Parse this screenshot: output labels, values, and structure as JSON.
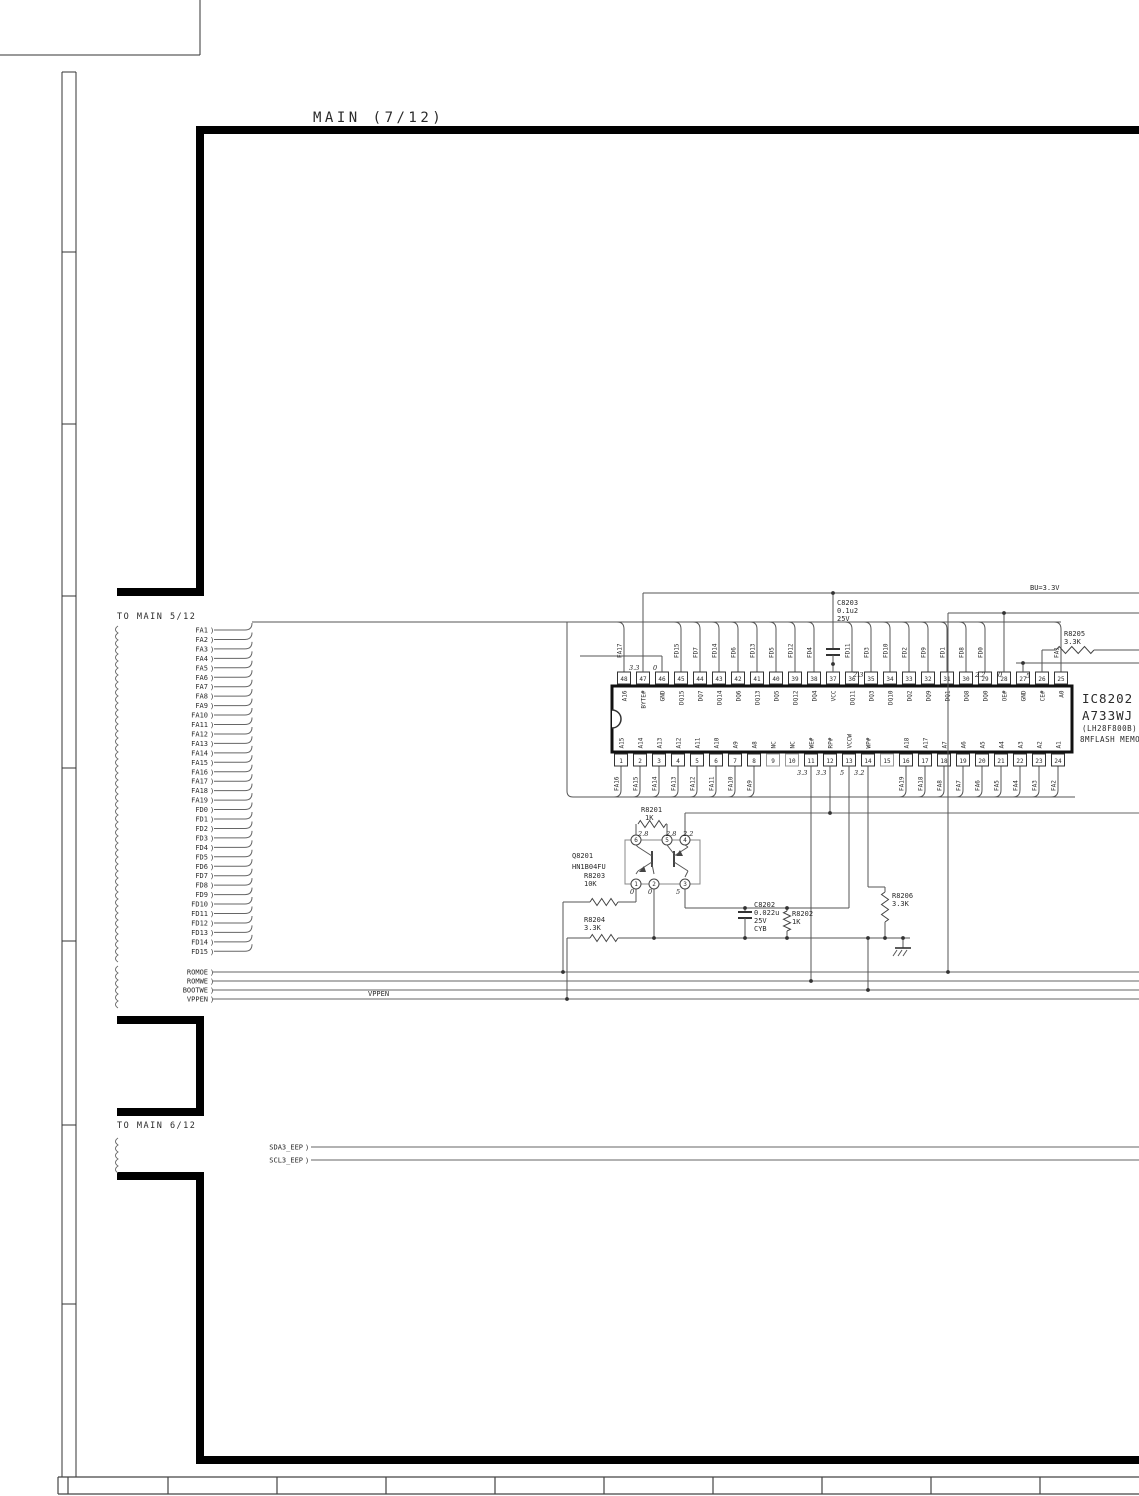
{
  "title": "MAIN (7/12)",
  "section_labels": {
    "to_main_5": "TO MAIN 5/12",
    "to_main_6": "TO MAIN 6/12"
  },
  "power_rail": "BU=3.3V",
  "bus_signals": [
    "FA1",
    "FA2",
    "FA3",
    "FA4",
    "FA5",
    "FA6",
    "FA7",
    "FA8",
    "FA9",
    "FA10",
    "FA11",
    "FA12",
    "FA13",
    "FA14",
    "FA15",
    "FA16",
    "FA17",
    "FA18",
    "FA19",
    "FD0",
    "FD1",
    "FD2",
    "FD3",
    "FD4",
    "FD5",
    "FD6",
    "FD7",
    "FD8",
    "FD9",
    "FD10",
    "FD11",
    "FD12",
    "FD13",
    "FD14",
    "FD15"
  ],
  "control_signals": [
    "ROMOE",
    "ROMWE",
    "BOOTWE",
    "VPPEN"
  ],
  "vppen_inline_label": "VPPEN",
  "eeprom_signals": [
    "SDA3_EEP",
    "SCL3_EEP"
  ],
  "ic": {
    "ref": "IC8202",
    "part": "A733WJ",
    "package": "(LH28F800B)",
    "description": "8MFLASH MEMORY",
    "top_pins": [
      {
        "pin": 48,
        "name": "A16",
        "net": "FA17"
      },
      {
        "pin": 47,
        "name": "BYTE#",
        "net": ""
      },
      {
        "pin": 46,
        "name": "GND",
        "net": ""
      },
      {
        "pin": 45,
        "name": "DQ15",
        "net": "FD15"
      },
      {
        "pin": 44,
        "name": "DQ7",
        "net": "FD7"
      },
      {
        "pin": 43,
        "name": "DQ14",
        "net": "FD14"
      },
      {
        "pin": 42,
        "name": "DQ6",
        "net": "FD6"
      },
      {
        "pin": 41,
        "name": "DQ13",
        "net": "FD13"
      },
      {
        "pin": 40,
        "name": "DQ5",
        "net": "FD5"
      },
      {
        "pin": 39,
        "name": "DQ12",
        "net": "FD12"
      },
      {
        "pin": 38,
        "name": "DQ4",
        "net": "FD4"
      },
      {
        "pin": 37,
        "name": "VCC",
        "net": ""
      },
      {
        "pin": 36,
        "name": "DQ11",
        "net": "FD11"
      },
      {
        "pin": 35,
        "name": "DQ3",
        "net": "FD3"
      },
      {
        "pin": 34,
        "name": "DQ10",
        "net": "FD10"
      },
      {
        "pin": 33,
        "name": "DQ2",
        "net": "FD2"
      },
      {
        "pin": 32,
        "name": "DQ9",
        "net": "FD9"
      },
      {
        "pin": 31,
        "name": "DQ1",
        "net": "FD1"
      },
      {
        "pin": 30,
        "name": "DQ8",
        "net": "FD8"
      },
      {
        "pin": 29,
        "name": "DQ0",
        "net": "FD0"
      },
      {
        "pin": 28,
        "name": "OE#",
        "net": ""
      },
      {
        "pin": 27,
        "name": "GND",
        "net": ""
      },
      {
        "pin": 26,
        "name": "CE#",
        "net": ""
      },
      {
        "pin": 25,
        "name": "A0",
        "net": "FA1"
      }
    ],
    "bottom_pins": [
      {
        "pin": 1,
        "name": "A15",
        "net": "FA16"
      },
      {
        "pin": 2,
        "name": "A14",
        "net": "FA15"
      },
      {
        "pin": 3,
        "name": "A13",
        "net": "FA14"
      },
      {
        "pin": 4,
        "name": "A12",
        "net": "FA13"
      },
      {
        "pin": 5,
        "name": "A11",
        "net": "FA12"
      },
      {
        "pin": 6,
        "name": "A10",
        "net": "FA11"
      },
      {
        "pin": 7,
        "name": "A9",
        "net": "FA10"
      },
      {
        "pin": 8,
        "name": "A8",
        "net": "FA9"
      },
      {
        "pin": 9,
        "name": "NC",
        "net": ""
      },
      {
        "pin": 10,
        "name": "NC",
        "net": ""
      },
      {
        "pin": 11,
        "name": "WE#",
        "net": ""
      },
      {
        "pin": 12,
        "name": "RP#",
        "net": ""
      },
      {
        "pin": 13,
        "name": "VCCW",
        "net": ""
      },
      {
        "pin": 14,
        "name": "WP#",
        "net": ""
      },
      {
        "pin": 15,
        "name": "",
        "net": ""
      },
      {
        "pin": 16,
        "name": "A18",
        "net": "FA19"
      },
      {
        "pin": 17,
        "name": "A17",
        "net": "FA18"
      },
      {
        "pin": 18,
        "name": "A7",
        "net": "FA8"
      },
      {
        "pin": 19,
        "name": "A6",
        "net": "FA7"
      },
      {
        "pin": 20,
        "name": "A5",
        "net": "FA6"
      },
      {
        "pin": 21,
        "name": "A4",
        "net": "FA5"
      },
      {
        "pin": 22,
        "name": "A3",
        "net": "FA4"
      },
      {
        "pin": 23,
        "name": "A2",
        "net": "FA3"
      },
      {
        "pin": 24,
        "name": "A1",
        "net": "FA2"
      }
    ]
  },
  "components": {
    "c8203": {
      "ref": "C8203",
      "value": "0.1u2",
      "voltage": "25V"
    },
    "r8205": {
      "ref": "R8205",
      "value": "3.3K"
    },
    "r8201": {
      "ref": "R8201",
      "value": "1K"
    },
    "q8201": {
      "ref": "Q8201",
      "part": "HN1B04FU",
      "pin_numbers": [
        "6",
        "5",
        "4",
        "1",
        "2",
        "3"
      ]
    },
    "r8203": {
      "ref": "R8203",
      "value": "10K"
    },
    "r8204": {
      "ref": "R8204",
      "value": "3.3K"
    },
    "c8202": {
      "ref": "C8202",
      "value": "0.022u",
      "voltage": "25V",
      "code": "CYB"
    },
    "r8202": {
      "ref": "R8202",
      "value": "1K"
    },
    "r8206": {
      "ref": "R8206",
      "value": "3.3K"
    }
  },
  "voltage_annotations": [
    "3.3",
    "0",
    "2.3",
    "2.2",
    "0",
    "5",
    "3.3",
    "3.3",
    "5",
    "3.2",
    "2.8",
    "2.8",
    "2.2",
    "0",
    "0",
    "5"
  ]
}
